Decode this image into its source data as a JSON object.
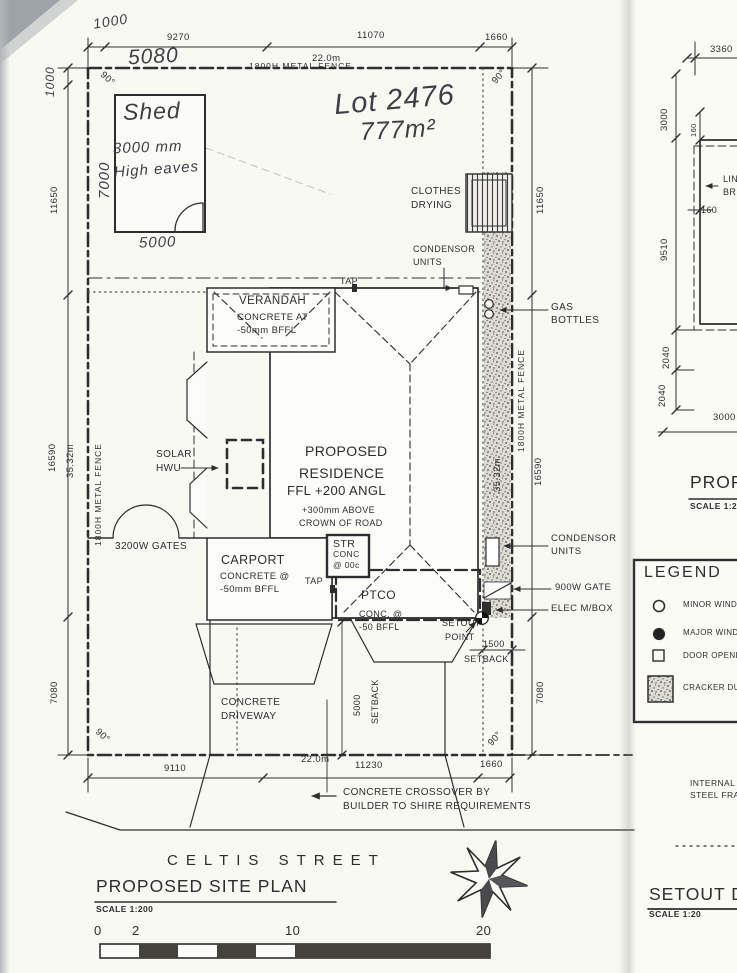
{
  "handwritten": {
    "offset_top": "1000",
    "dim_5080": "5080",
    "offset_left": "1000",
    "shed_width": "7000",
    "shed_name": "Shed",
    "shed_note1": "3000 mm",
    "shed_note2": "High eaves",
    "shed_depth": "5000",
    "lot_number": "Lot 2476",
    "lot_area": "777m²"
  },
  "dims": {
    "top": {
      "d1": "9270",
      "d2": "11070",
      "d3": "1660",
      "total": "22.0m"
    },
    "bottom": {
      "d1": "9110",
      "d2": "11230",
      "d3": "1660",
      "total": "22.0m"
    },
    "left": {
      "d1": "11650",
      "d2": "16590",
      "total": "35.32m",
      "d3": "7080"
    },
    "right": {
      "d1": "11650",
      "d2": "16590",
      "total": "35.32m",
      "d3": "7080"
    },
    "setback_right": {
      "value": "1500",
      "label": "SETBACK"
    },
    "setback_front": {
      "value": "5000",
      "label": "SETBACK"
    },
    "angle": "90°"
  },
  "fences": {
    "top": "1800H METAL FENCE",
    "left": "1800H METAL FENCE",
    "right": "1800H METAL FENCE"
  },
  "features": {
    "clothes": [
      "CLOTHES",
      "DRYING"
    ],
    "condensor_top": [
      "CONDENSOR",
      "UNITS"
    ],
    "tap_top": "TAP",
    "tap_mid": "TAP",
    "gas": [
      "GAS",
      "BOTTLES"
    ],
    "verandah": [
      "VERANDAH",
      "CONCRETE AT",
      "-50mm BFFL"
    ],
    "solar": [
      "SOLAR",
      "HWU"
    ],
    "residence": [
      "PROPOSED",
      "RESIDENCE",
      "FFL +200 ANGL",
      "+300mm ABOVE",
      "CROWN OF ROAD"
    ],
    "gates": "3200W GATES",
    "carport": [
      "CARPORT",
      "CONCRETE @",
      "-50mm BFFL"
    ],
    "str": [
      "STR",
      "CONC",
      "@ 00c"
    ],
    "ptco": [
      "PTCO",
      "CONC. @",
      "-50 BFFL"
    ],
    "condensor_right": [
      "CONDENSOR",
      "UNITS"
    ],
    "gate_900": "900W GATE",
    "elec": "ELEC M/BOX",
    "setout": [
      "SETOUT",
      "POINT"
    ],
    "driveway": [
      "CONCRETE",
      "DRIVEWAY"
    ],
    "crossover": [
      "CONCRETE CROSSOVER BY",
      "BUILDER TO SHIRE REQUIREMENTS"
    ]
  },
  "titles": {
    "street": "CELTIS STREET",
    "plan": "PROPOSED SITE PLAN",
    "plan_scale": "SCALE 1:200",
    "setout_detail": "SETOUT DET",
    "setout_scale": "SCALE 1:20",
    "detail_fragment": "PROP",
    "detail_scale": "SCALE 1:20"
  },
  "scalebar": {
    "t0": "0",
    "t2": "2",
    "t10": "10",
    "t20": "20"
  },
  "legend": {
    "title": "LEGEND",
    "items": [
      "MINOR WINDO",
      "MAJOR WINDO",
      "DOOR OPENIN",
      "CRACKER DUS"
    ]
  },
  "side_detail": {
    "d3360": "3360",
    "d3000_top": "3000",
    "d160_a": "160",
    "d160_b": "160",
    "d9510": "9510",
    "d2040_a": "2040",
    "d2040_b": "2040",
    "d3000_bot": "3000",
    "note1": "LIN",
    "note2": "BRI",
    "internal1": "INTERNAL",
    "internal2": "STEEL FRA"
  }
}
